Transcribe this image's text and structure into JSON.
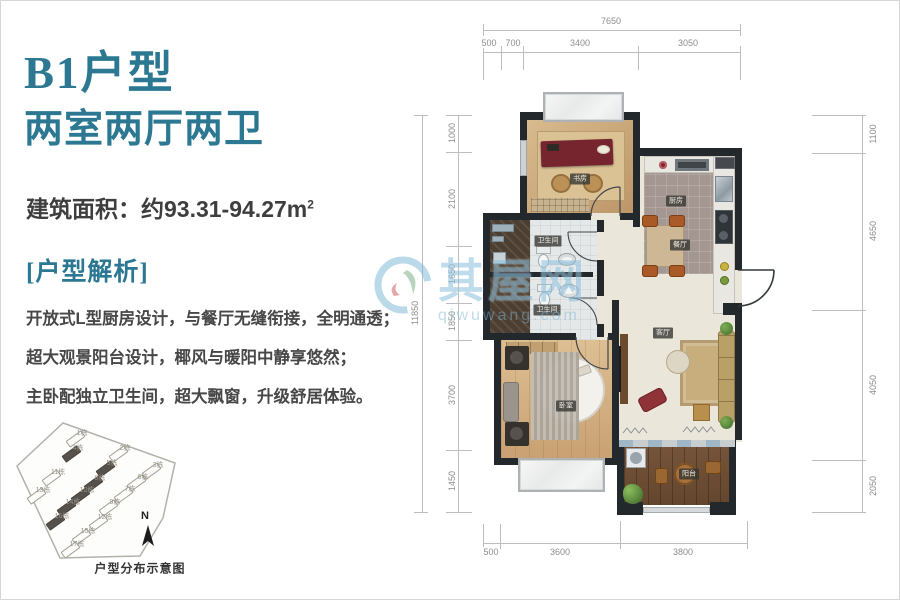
{
  "panel": {
    "title": "B1户型",
    "subtitle": "两室两厅两卫",
    "area_text": "建筑面积：约93.31-94.27m",
    "area_sup": "2",
    "section_title": "[户型解析]",
    "desc_lines": [
      "开放式L型厨房设计，与餐厅无缝衔接，全明通透；",
      "超大观景阳台设计，椰风与暖阳中静享悠然；",
      "主卧配独立卫生间，超大飘窗，升级舒居体验。"
    ]
  },
  "sitemap": {
    "compass": "N",
    "caption": "户型分布示意图",
    "buildings": [
      {
        "label": "1栋",
        "x": 67,
        "y": 15,
        "dark": false
      },
      {
        "label": "4栋",
        "x": 63,
        "y": 30,
        "dark": true
      },
      {
        "label": "2栋",
        "x": 110,
        "y": 30,
        "dark": false
      },
      {
        "label": "5栋",
        "x": 97,
        "y": 45,
        "dark": true
      },
      {
        "label": "3栋",
        "x": 143,
        "y": 47,
        "dark": false
      },
      {
        "label": "11栋",
        "x": 43,
        "y": 54,
        "dark": false
      },
      {
        "label": "8栋",
        "x": 85,
        "y": 60,
        "dark": true
      },
      {
        "label": "6栋",
        "x": 128,
        "y": 59,
        "dark": false
      },
      {
        "label": "13栋",
        "x": 28,
        "y": 72,
        "dark": false
      },
      {
        "label": "10栋",
        "x": 72,
        "y": 72,
        "dark": true
      },
      {
        "label": "7栋",
        "x": 115,
        "y": 71,
        "dark": false
      },
      {
        "label": "14栋",
        "x": 58,
        "y": 84,
        "dark": true
      },
      {
        "label": "9栋",
        "x": 100,
        "y": 84,
        "dark": false
      },
      {
        "label": "16栋",
        "x": 47,
        "y": 98,
        "dark": true
      },
      {
        "label": "12栋",
        "x": 90,
        "y": 99,
        "dark": false
      },
      {
        "label": "15栋",
        "x": 73,
        "y": 113,
        "dark": false
      },
      {
        "label": "17栋",
        "x": 62,
        "y": 126,
        "dark": false
      }
    ]
  },
  "plan": {
    "rooms": [
      {
        "name": "书房",
        "x": 101,
        "y": 95
      },
      {
        "name": "厨房",
        "x": 197,
        "y": 117
      },
      {
        "name": "餐厅",
        "x": 201,
        "y": 161
      },
      {
        "name": "卫生间",
        "x": 69,
        "y": 157
      },
      {
        "name": "卫生间",
        "x": 68,
        "y": 226
      },
      {
        "name": "卧室",
        "x": 87,
        "y": 322
      },
      {
        "name": "客厅",
        "x": 184,
        "y": 249
      },
      {
        "name": "阳台",
        "x": 210,
        "y": 390
      }
    ],
    "dims": {
      "top_overall": "7650",
      "top_segs": [
        "500",
        "700",
        "3400",
        "3050"
      ],
      "left_overall": "11850",
      "left_segs": [
        "1000",
        "2100",
        "1650",
        "1850",
        "3700",
        "1450"
      ],
      "right_segs": [
        "1100",
        "4650",
        "4050",
        "2050"
      ],
      "bottom_segs": [
        "500",
        "3600",
        "3800"
      ]
    }
  },
  "watermark": {
    "brand": "其屋网",
    "url": "qiwuwang.com"
  },
  "colors": {
    "accent_teal": "#2c7893",
    "wall": "#23282c",
    "watermark_blue": "#7db8d8"
  }
}
